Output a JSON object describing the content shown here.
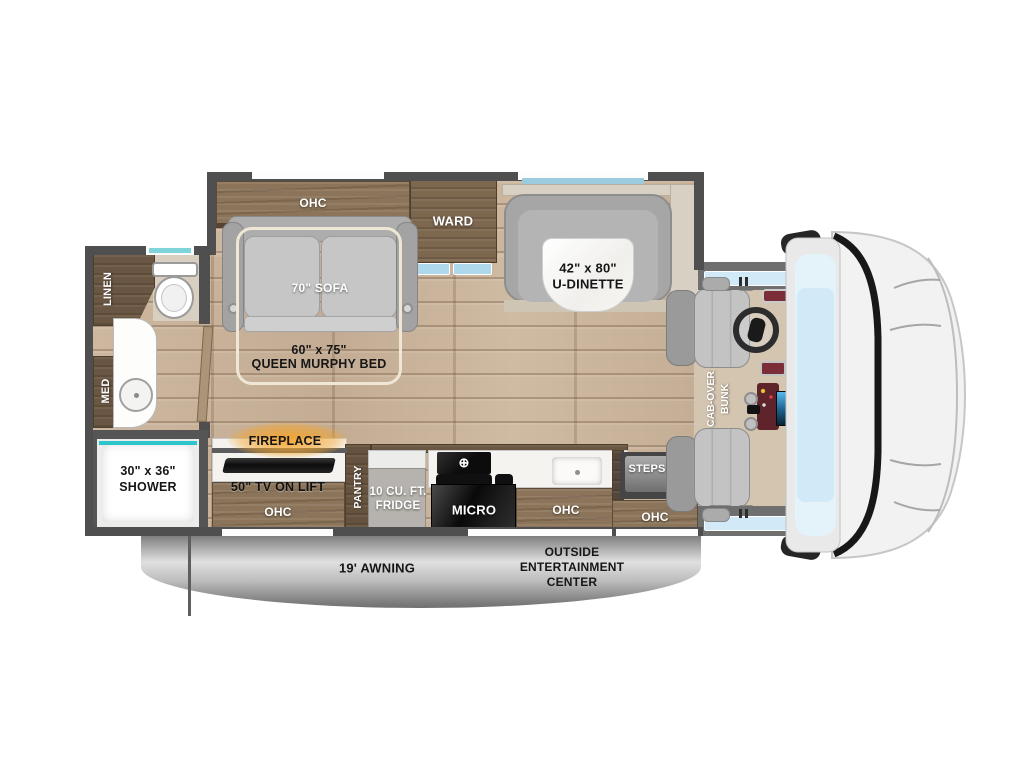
{
  "colors": {
    "wall": "#4f4f4f",
    "floor-wood": "#c9b39c",
    "cabinet-wood": "#8b7459",
    "dark-wood": "#6a5743",
    "slide-beige": "#d8d1c3",
    "bench-gray": "#a6a6a6",
    "window-blue": "#aed9ec",
    "windshield-blue": "#d2eaf7",
    "teal-accent": "#2cc5cb",
    "fireplace-glow": "#f5a42a"
  },
  "labels": {
    "bathroom": {
      "linen": "LINEN",
      "med": "MED",
      "shower1": "30\" x 36\"",
      "shower2": "SHOWER"
    },
    "bedroom": {
      "ohc": "OHC",
      "sofa": "70\" SOFA",
      "murphy1": "60\" x 75\"",
      "murphy2": "QUEEN MURPHY BED",
      "ward": "WARD"
    },
    "dinette": {
      "size": "42\" x 80\"",
      "name": "U-DINETTE"
    },
    "kitchen": {
      "fireplace": "FIREPLACE",
      "tv": "50\" TV ON LIFT",
      "ohc_tv": "OHC",
      "pantry": "PANTRY",
      "fridge1": "10 CU. FT.",
      "fridge2": "FRIDGE",
      "micro": "MICRO",
      "ohc_kitchen": "OHC"
    },
    "entry": {
      "steps": "STEPS",
      "ohc": "OHC"
    },
    "cab": {
      "bunk1": "CAB-OVER",
      "bunk2": "BUNK"
    },
    "exterior": {
      "awning": "19' AWNING",
      "ent1": "OUTSIDE",
      "ent2": "ENTERTAINMENT",
      "ent3": "CENTER"
    }
  }
}
